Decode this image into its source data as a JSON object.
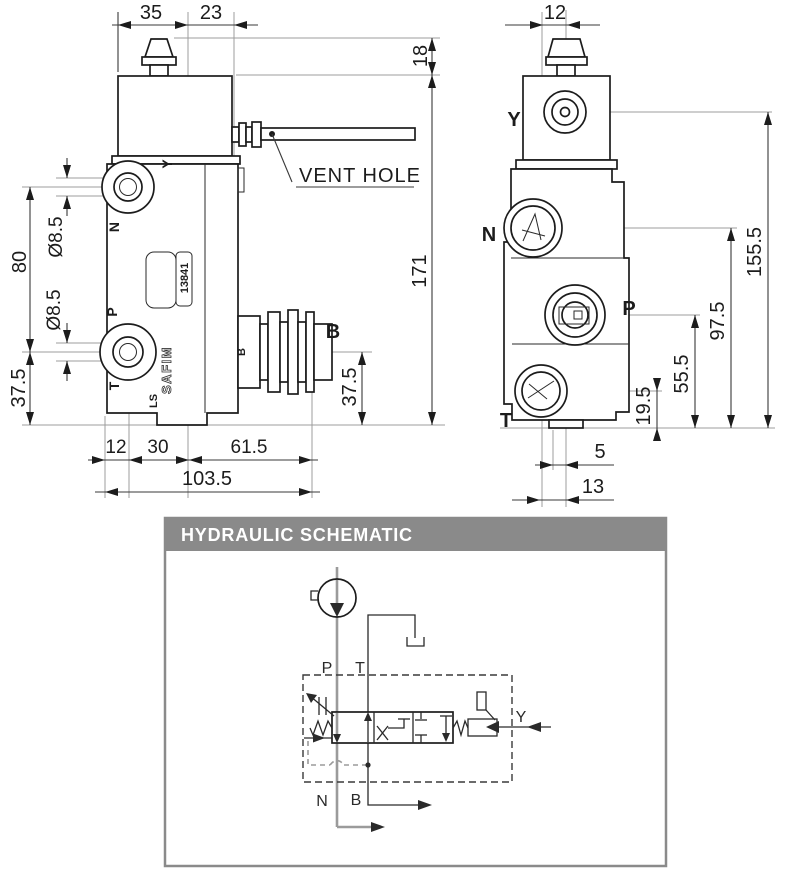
{
  "front_view": {
    "dims": {
      "w35": "35",
      "w23": "23",
      "h18": "18",
      "h171": "171",
      "h80": "80",
      "dia_y": "Ø8.5",
      "dia_p": "Ø8.5",
      "h37_5_left": "37.5",
      "h37_5_b": "37.5",
      "w12": "12",
      "w30": "30",
      "w61_5": "61.5",
      "w103_5": "103.5"
    },
    "port_labels": {
      "y": "Y",
      "n": "N",
      "p": "P",
      "t": "T",
      "b_small": "B",
      "b_callout": "B"
    },
    "markings": {
      "ls": "LS",
      "brand": "SAFIM",
      "code": "13841"
    },
    "vent_callout": "VENT HOLE"
  },
  "side_view": {
    "dims": {
      "w12": "12",
      "h155_5": "155.5",
      "h97_5": "97.5",
      "h55_5": "55.5",
      "h19_5": "19.5",
      "w5": "5",
      "w13": "13"
    },
    "port_labels": {
      "y": "Y",
      "n": "N",
      "p": "P",
      "t": "T"
    }
  },
  "schematic": {
    "title": "HYDRAULIC SCHEMATIC",
    "port_labels": {
      "p": "P",
      "t": "T",
      "n": "N",
      "b": "B",
      "y": "Y"
    }
  },
  "colors": {
    "line": "#1c1c1c",
    "centerline": "#9c9c9c",
    "header_bg": "#8a8a8a",
    "header_text": "#ffffff",
    "panel_bg": "#ffffff"
  }
}
